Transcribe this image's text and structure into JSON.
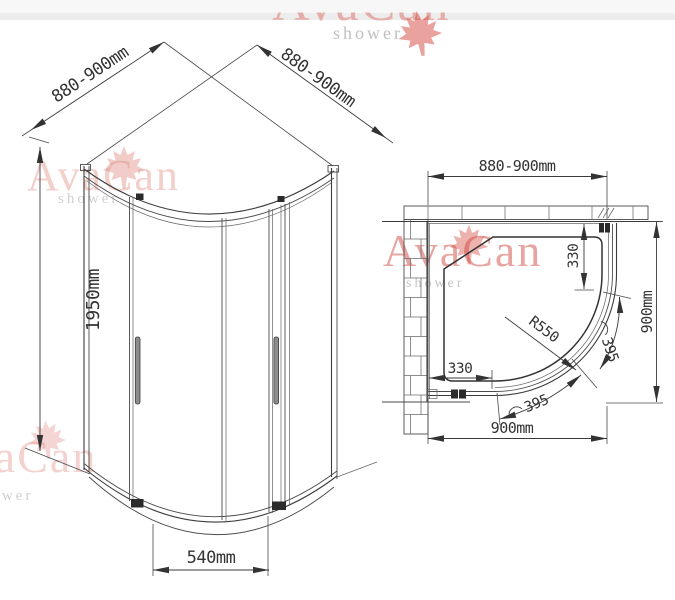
{
  "watermark": {
    "brand": "AvaCan",
    "subtitle": "shower",
    "brand_color": "#d9574f",
    "leaf_color": "#dd6e64",
    "subtitle_color": "#a9a9a9"
  },
  "front_view": {
    "width_left": "880-900mm",
    "width_right": "880-900mm",
    "height": "1950mm",
    "door_opening": "540mm"
  },
  "plan_view": {
    "width_top": "880-900mm",
    "depth_right": "900mm",
    "width_bottom": "900mm",
    "fixed_segment_right": "330",
    "fixed_segment_bottom": "330",
    "corner_radius": "R550",
    "door_arc_right": "395",
    "door_arc_bottom": "395"
  }
}
